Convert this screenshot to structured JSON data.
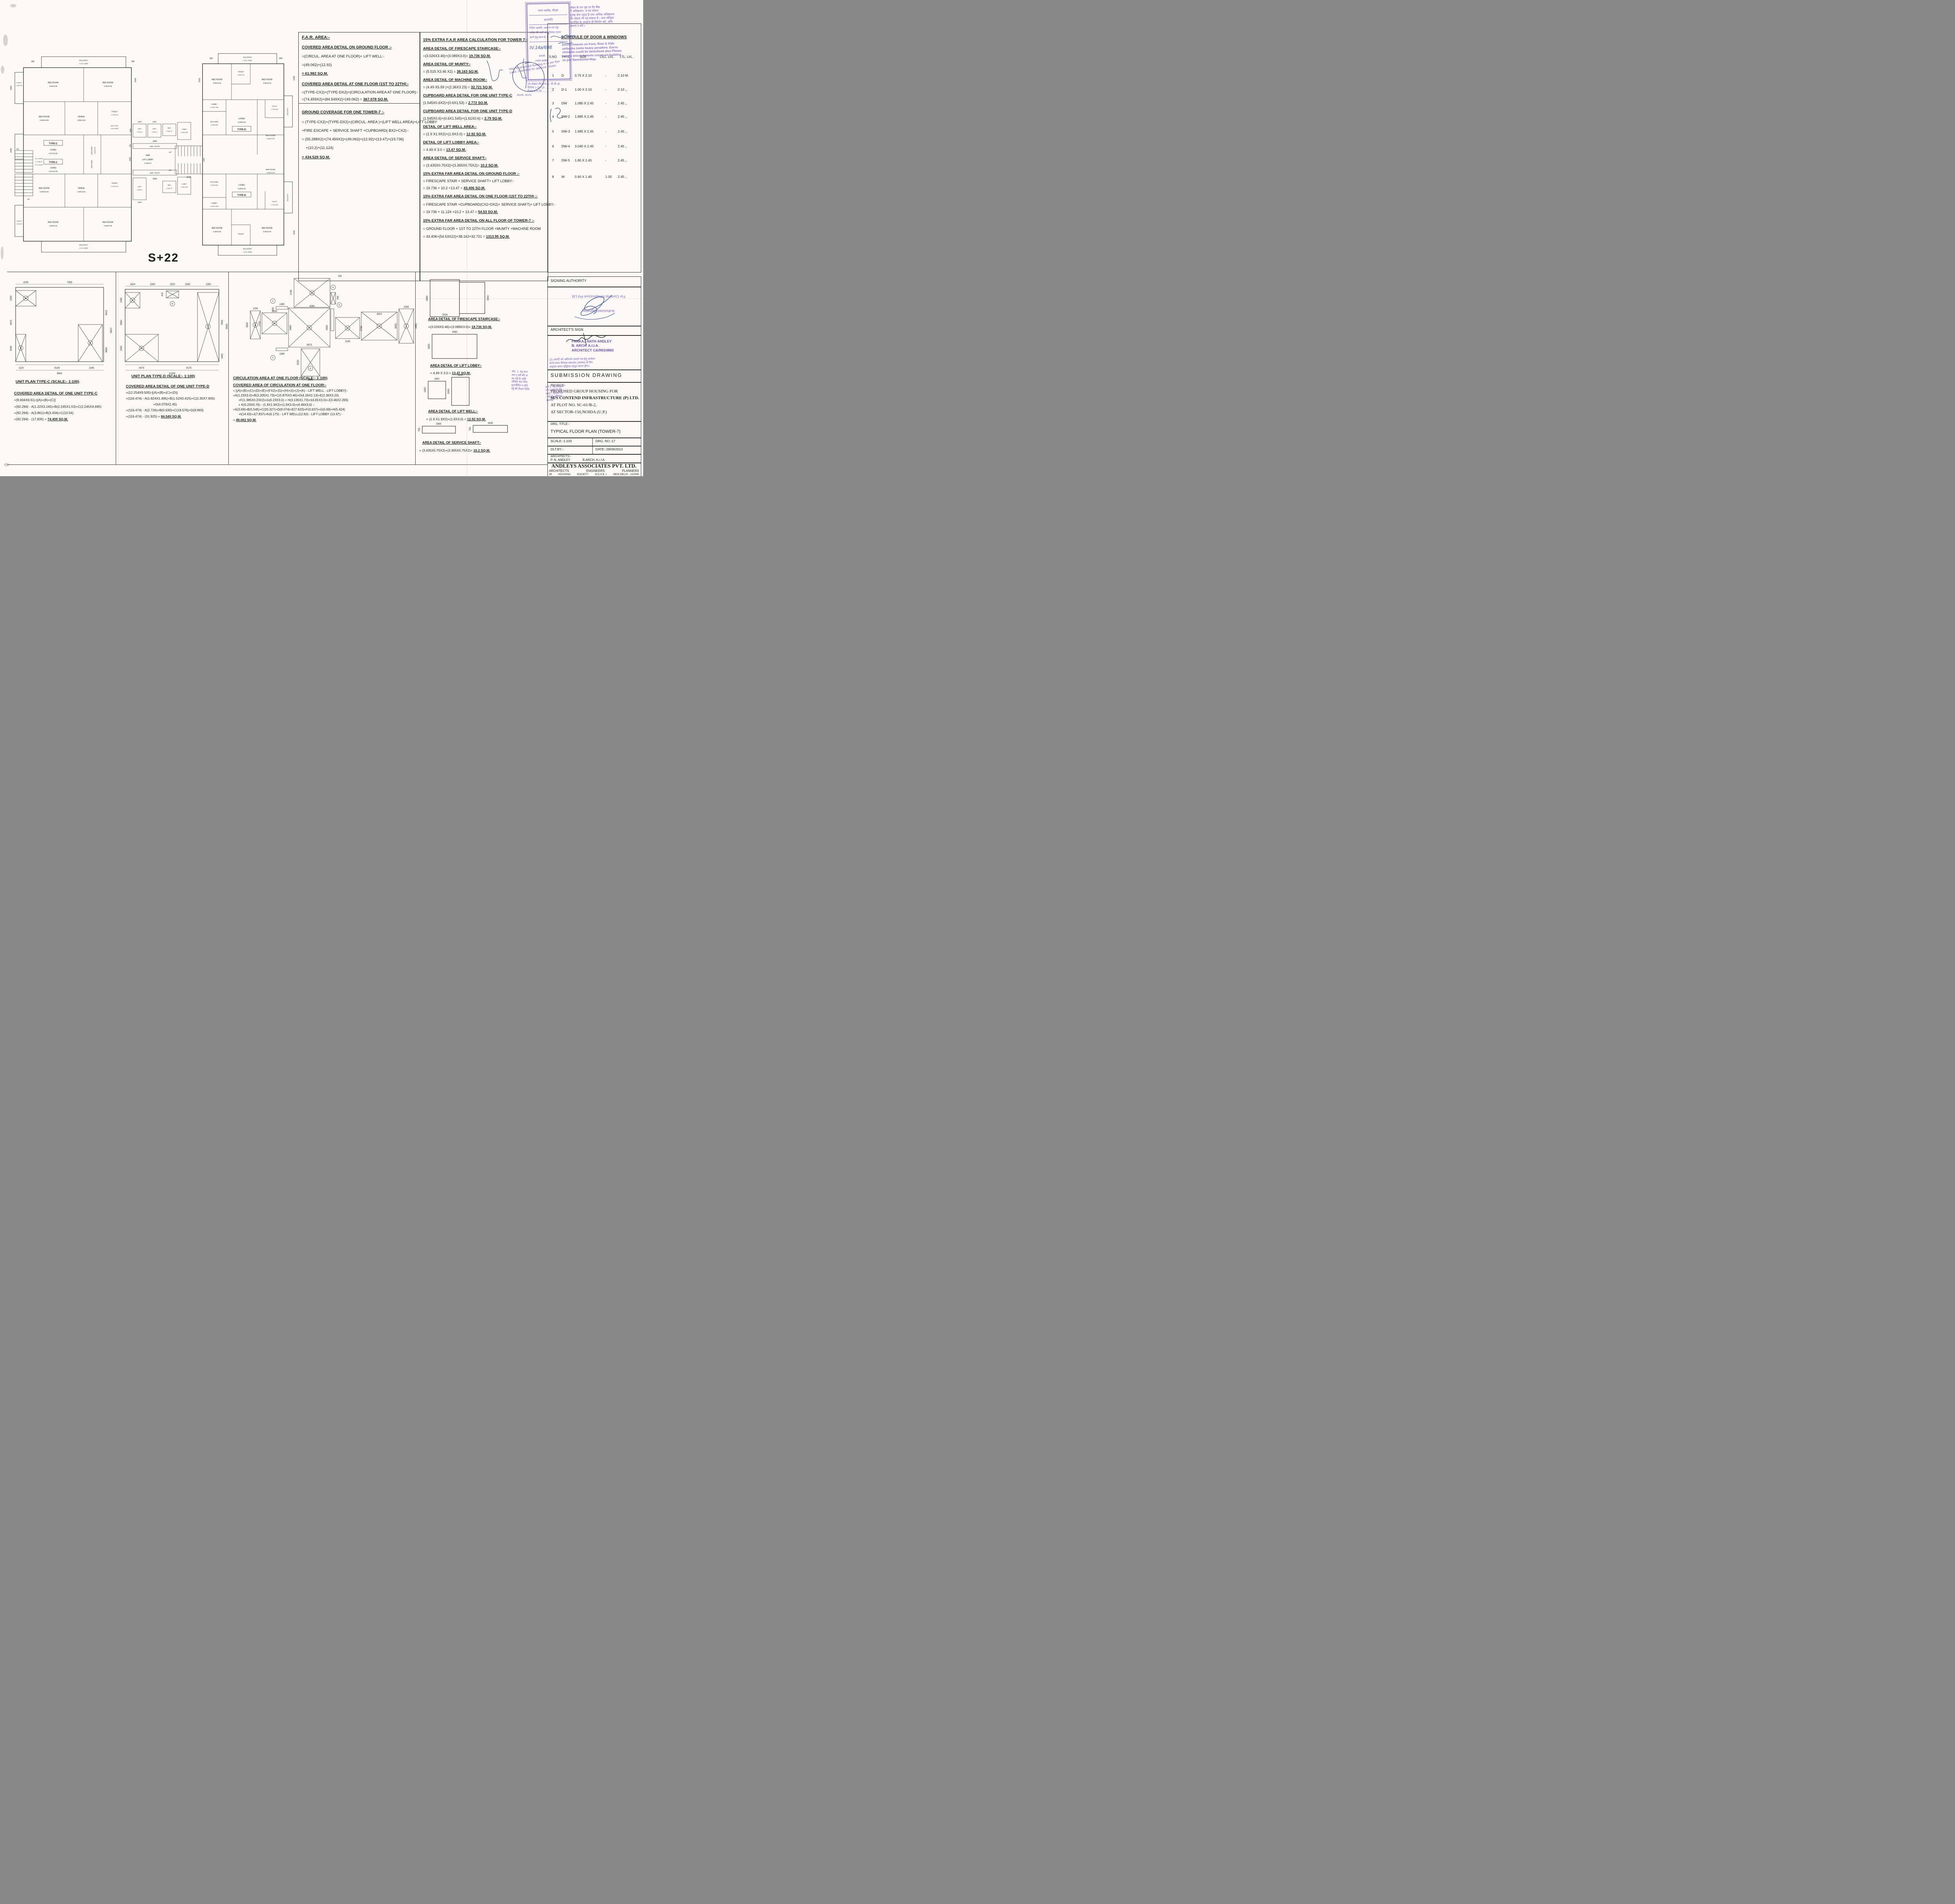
{
  "plan": {
    "storeys": "S+22",
    "type_c": "TYPE-C",
    "type_d": "TYPE-D",
    "balcony": "BALCONY",
    "balcony_w": "1.5 M. WIDE",
    "bed": "BED ROOM",
    "bed_366": "3.66X3.05",
    "bed_335": "3.35X3.05",
    "bed_3964": "3.964X3.05",
    "bed_d": "3.05X3.66",
    "toilet": "TOILET",
    "toilet_c": "2.13x1.52",
    "toilet_d1": "1.52x2.13",
    "toilet_d2": "1.71x2.165",
    "dining": "DINING",
    "dining_s": "3.05X3.05",
    "living": "LIVING",
    "living_c": "3.974X3.05",
    "living_d": "3.35X5.50",
    "kitchen": "KITCHEN",
    "kitchen_c": "1.82X3.05",
    "kitchen_d": "2.13X3.05",
    "lift": "LIFT",
    "lift_19": "1.9X1.9",
    "lift_193": "1.9X3.0",
    "lift_lobby": "LIFT LOBBY",
    "lift_lobby_s": "4.49X3.0",
    "ser_shaft": "SER. SHAFT",
    "wc": "W.C",
    "wc_s": "2.12x1.37",
    "lobby": "LOBBY",
    "lobby_s": "2.13X2.335",
    "up": "UP",
    "dn": "DN",
    "stair_w": "W.=1.50 M.",
    "stair_t": "T.=0.30 M.",
    "stair_r": "R.=0.15 M.",
    "d600": "600",
    "d1530": "1530",
    "d1545": "1545",
    "d1610": "1610",
    "d1495": "1495",
    "d4490": "4490",
    "d3365": "3365",
    "d1900": "1900",
    "d3000": "3000",
    "d4730": "4730",
    "d3435": "3435",
    "d750": "750",
    "d1500": "1500"
  },
  "far_area": {
    "title": "F.A.R. AREA:-",
    "s1_h": "COVERED AREA DETAIL ON GROUND FLOOR :-",
    "s1_l1": "=(CIRCUL. AREA AT ONE FLOOR)+ LIFT WELL:-",
    "s1_l2": "=(49.062)+(12.92)",
    "s1_r": "= 61.982 SQ.M.",
    "s2_h": "COVERED AREA DETAIL AT ONE FLOOR (1ST TO 22TH):-",
    "s2_l1": "=(TYPE-CX2)+(TYPE-DX2)+(CIRCULATION AREA AT ONE FLOOR):-",
    "s2_l2a": "=(74.459X2)+(84.549X2)+(49.062) = ",
    "s2_l2b": "367.078 SQ.M.",
    "gc_h": "GROUND COVERAGE FOR ONE TOWER-7 :-",
    "gc_l1": "= (TYPE-CX2)+(TYPE-DX2)+(CIRCUL. AREA )+(LIFT WELL AREA)+LIFT LOBBY",
    "gc_l2": "+FIRE ESCAPE + SERVICE SHAFT +CUPBOARD( BX2+CX2):-",
    "gc_l3": "= (55.288X2)+(74.459X2)+(49.062)+(12.92)+(13.47)+(19.736)",
    "gc_l4": "+(10.2)+(11.124)",
    "gc_r": "= 434.528 SQ.M."
  },
  "extra_far": {
    "title": "15% EXTRA F.A.R AREA CALCULATION FOR TOWER 7:-",
    "items": [
      {
        "h": "AREA DETAIL OF FIRESCAPE STAIRCASE:-",
        "f": "=(3.026X3.46)+(3.089X3.0)= ",
        "r": "19.736 SQ.M."
      },
      {
        "h": "AREA DETAIL OF MUMTY:-",
        "f": "= (5.515 X3.46 X2)  = ",
        "r": "38.163 SQ.M."
      },
      {
        "h": "AREA DETAIL OF MACHINE ROOM:-",
        "f": "= (4.49 X5.59 )+(2.36X3.23)  = ",
        "r": "32.721 SQ.M."
      },
      {
        "h": "CUPBOARD AREA DETAIL FOR ONE UNIT TYPE-C",
        "f": "(1.545X0.6X2)+(0.6X1.53) = ",
        "r": "2.772 SQ.M."
      },
      {
        "h": "CUPBOARD AREA DETAIL FOR ONE UNIT TYPE-D",
        "f": "(1.545X0.6)+(0.6X1.545)+(1.61X0.6) = ",
        "r": "2.79 SQ.M."
      },
      {
        "h": "DETAIL OF LIFT WELL AREA:-",
        "f": "= (1.9 X1.9X2)+(1.9X3.0)  = ",
        "r": "12.92 SQ.M."
      },
      {
        "h": "DETAIL OF LIFT LOBBY AREA:-",
        "f": "= 4.49 X 3.0  = ",
        "r": "13.47 SQ.M."
      },
      {
        "h": "AREA DETAIL OF SERVICE SHAFT:-",
        "f": "= (3.435X0.75X2)+(3.365X0.75X2)= ",
        "r": "10.2 SQ.M."
      },
      {
        "h": "15% EXTRA FAR AREA DETAIL  ON GROUND FLOOR :-",
        "l1": "= FIRESCAPE STAIR + SERVICE SHAFT+ LIFT LOBBY:-",
        "f": "= 19.736 + 10.2 +13.47  = ",
        "r": "43.406 SQ.M."
      },
      {
        "h": "15% EXTRA FAR AREA DETAIL ON ONE FLOOR (1ST TO 22TH) :-",
        "l1": "= FIRESCAPE STAIR +CUPBOARD(CX2+DX2)+ SERVICE SHAFT)+ LIFT LOBBY:-",
        "f": "= 19.736 + 11.124 +10.2 + 13.47 = ",
        "r": "54.53 SQ.M."
      },
      {
        "h": "15% EXTRA FAR AREA DETAIL ON ALL FLOOR OF TOWER-7 :-",
        "l1": "= GROUND FLOOR + 1ST  TO 22TH FLOOR +MUMTY  +MACHINE ROOM",
        "f": "= 43.406+(54.53X22)+38.163+32.721 = ",
        "r": "1313.95 SQ.M."
      }
    ]
  },
  "schedule": {
    "title": "SCHEDULE OF DOOR & WINDOWS",
    "headers": [
      "S.NO.",
      "TYPE",
      "SIZE",
      "CILL. LVL.",
      "LTL. LVL."
    ],
    "rows": [
      [
        "1",
        "D",
        "0.75  X 2.10",
        "-",
        "2.10 M."
      ],
      [
        "2",
        "D-1",
        "1.00   X 2.10",
        "-",
        "2.10 ,,"
      ],
      [
        "3",
        "DW",
        "1.080 X 2.45",
        "-",
        "2.45 ,,"
      ],
      [
        "4",
        "DW-2",
        "1.885 X 2.45",
        "-",
        "2.45 ,,"
      ],
      [
        "5",
        "DW-3",
        "1.685 X 2.45",
        "-",
        "2.45 ,,"
      ],
      [
        "6",
        "DW-4",
        "3.040 X 2.45",
        "-",
        "2.45 ,,"
      ],
      [
        "7",
        "DW-5",
        "1.80   X 2.45",
        "-",
        "2.45 ,,"
      ],
      [
        "8",
        "W",
        "0.60  X 1.40",
        "1.05",
        "2.45 ,,"
      ]
    ]
  },
  "unit_c": {
    "title": "UNIT PLAN TYPE-C  (SCALE:- 1:100)",
    "heading": "COVERED AREA DETAIL OF ONE UNIT TYPE-C",
    "l1": "=(9.604X9.61)-[(A)+(B)+(C)]",
    "l2": "=(92.294) - A(1.22X3.165)+B(2.245X1.53)+C(2.245X4.695)",
    "l3": "=(92.294) - A(3.861)+B(3.434)+C(10.54)",
    "l4a": "=(92.294) - (17.835) = ",
    "l4b": "74.459 SQ.M.",
    "marks": [
      "A",
      "B",
      "C"
    ],
    "dims": {
      "t1": "2245",
      "t2": "7359",
      "lf1": "1530",
      "lf2": "4915",
      "lf3": "3165",
      "b1": "1220",
      "b2": "6139",
      "b3": "2245",
      "b4": "9604",
      "r1": "4915",
      "r2": "9610",
      "r3": "4695"
    }
  },
  "unit_d": {
    "title": "UNIT PLAN TYPE-D  (SCALE:- 1:100)",
    "heading": "COVERED AREA DETAIL OF ONE UNIT TYPE-D",
    "l1": "=(12.254X9.505)-[(A)+(B)+(C)+(D)]",
    "l2": "=(116.474) - A(1.824X1.495)+B(1.52X0.415)+C(2.35X7.905)",
    "l3": "+D(4.079X2.45)",
    "l4": "=(116.474) - A(2.726)+B(0.630)+C(18.576)+D(9.993)",
    "l5a": "=(116.474) - (31.925) = ",
    "l5b": "84.549 SQ.M.",
    "marks": [
      "A",
      "B",
      "C",
      "D"
    ],
    "dims": {
      "t1": "1824",
      "t2": "3280",
      "t3": "1520",
      "t4": "3280",
      "t5": "2350",
      "bh": "415",
      "lf1": "1495",
      "lf2": "5560",
      "lf3": "2450",
      "b1": "4079",
      "b2": "8175",
      "b3": "12254",
      "r1": "7905",
      "r2": "9505",
      "r3": "1600"
    }
  },
  "circulation": {
    "title": "CIRCULATION AREA AT ONE FLOOR  (SCALE:- 1:100)",
    "heading": "COVERED AREA OF CIRCULATION AT ONE FLOOR:-",
    "l1": "= [(A)+(B)+(C)+(D)+(E)+(FX2)+(G)+(H)+(I)+(J)+(K) - LIFT WELL - LIFT LOBBY]:-",
    "l2": "=A(1.23X3.0)+B(3.205X1.73)+C(5.875X3.46)+D(4.26X2.13)+E(2.36X3.23)",
    "l3": "+F(1.385X0.23X2)+G(0.23X3.0) + H(3.135X1.73)+I(4.81X3.0)+J(3.46X2.265)",
    "l4": "+ K(0.23X0.76) - (1.9X1.9X2)+(1.9X3.0)+(4.49X3.0) :-",
    "l5": "=A(3.69)+B(5.545)+C(20.327)+D(9.074)+E(7.623)+F(0.637)+G(0.69)+H(5.424)",
    "l6": "+I(14.43)+J(7.837)+K(0.175) - LIFT WELL(12.92) - LIFT LOBBY (13.47):-",
    "ra": "= ",
    "rb": "49.062  SQ.M.",
    "marks": [
      "A",
      "B",
      "C",
      "D",
      "E",
      "F",
      "G",
      "H",
      "I",
      "J",
      "K"
    ],
    "dims": {
      "d2130": "2130",
      "d4260": "4260",
      "d230": "230",
      "d760": "760",
      "d1385": "1385",
      "d1230": "1230",
      "d3000": "3000",
      "d3205": "3205",
      "d1730": "1730",
      "d3460": "3460",
      "d5875": "5875",
      "d3135": "3135",
      "d4810": "4810",
      "d2265": "2265",
      "d3230": "3230",
      "d2360": "2360"
    }
  },
  "area_details": {
    "firescape": {
      "h": "AREA DETAIL OF FIRESCAPE STAIRCASE:-",
      "f": "=(3.026X3.46)+(3.089X3.0)= ",
      "r": "19.736 SQ.M.",
      "d1": "3460",
      "d2": "3026",
      "d3": "3000"
    },
    "lift_lobby": {
      "h": "AREA DETAIL OF LIFT LOBBY:-",
      "f": "= 4.49 X 3.0   = ",
      "r": "13.47 SQ.M.",
      "d1": "4490",
      "d2": "3000"
    },
    "lift_well": {
      "h": "AREA DETAIL OF LIFT WELL:-",
      "f": "= (1.9 X1.9X2)+(1.9X3.0)  = ",
      "r": "12.92 SQ.M.",
      "d1": "1900",
      "d2": "1900",
      "d3": "1900",
      "d4": "3000"
    },
    "service_shaft": {
      "h": "AREA DETAIL OF SERVICE SHAFT:-",
      "f": "= (3.435X0.75X2)+(3.365X0.75X2)= ",
      "r": "10.2 SQ.M.",
      "d1": "3365",
      "d2": "750",
      "d3": "3435",
      "d4": "750"
    }
  },
  "title_block": {
    "signing_authority": "SIGNING AUTHORITY",
    "architects_sign": "ARCHITECT'S SIGN",
    "submission": "SUBMISSION  DRAWING",
    "project_label": "PROJECT:-",
    "project_l1": "PROPOSED GROUP HOUSING FOR",
    "project_l2": "M/S CONTEND INFRASTRUCTURE (P) LTD.",
    "project_l3": "AT PLOT NO. SC-01/B-2,",
    "project_l4": "AT SECTOR-150,NOIDA (U.P.)",
    "drg_title_label": "DRG. TITLE:-",
    "drg_title": "TYPICAL FLOOR PLAN (TOWER-7)",
    "scale": "SCALE:-1:100",
    "drg_no": "DRG. NO.:17",
    "dlt_by": "DLT.BY.:-",
    "date": "DATE:-29/08/2013",
    "architects_label": "ARCHITECTS:-",
    "architect_name": "P. N. ANDLEY",
    "architect_qual": "B.ARCH.   A.I.I.A.",
    "firm": "ANDLEYS  ASSOCIATES  PVT.  LTD.",
    "firm_roles": [
      "ARCHITECTS",
      "ENGINEERS",
      "PLANNERS"
    ],
    "firm_addr": [
      "39",
      "HOUSING",
      "SOCIETY",
      "N.D.S.E.-I",
      "NEW DELHI - 110049"
    ]
  },
  "stamps": {
    "box_title": "भवन प्रकोष्ठ, नौएडा",
    "box_sub": "अनापत्ति",
    "box_l1": "निदेश-आबंटी, आबंटन एवं पट्टा",
    "box_l2": "प्रलेख की शर्तों को पूर्णतया पालन",
    "box_l3": "करने हेतु बाध्य है ।",
    "box_hand": "IV.14a/698",
    "box_post1": "प्रभारी",
    "box_post2": "(भवन प्रकोष्ठ)",
    "box_f1": "पत्र संख्या नौएडा/भ.प्र. वी.वी.आ.",
    "box_f2": "दिनांक 1-11-13 .............",
    "box_f3": "वैधता 5.4.25 .............",
    "enc_h1": "अंकर के यग पृष्ठ पर मैट बैंक",
    "enc_h2": "में अतिक्रमण, जं घर योजन",
    "enc_h3": "शुल्क देना पड़ता है तथा अधिक अतिक्रमण",
    "enc_h4": "का तोड़ना भी पड़ सकता है । अतः स्वीकृत",
    "enc_h5": "मानचित्र के अनुसार ही निर्माण करें, अति-",
    "enc_h6": "क्रमण न करें ।",
    "enc_e1": "Encrochments on front, Rear & Side",
    "enc_e2": "setbacks invite heavy penalties. Encro",
    "enc_e3": "chments could be demolised also Please",
    "enc_e4": "avoide encrochments construct building",
    "enc_e5": "as per Sanctioned Map.",
    "map_l1": "Map for proposed Building is as per Bye",
    "map_l2": "Laws. Submitted for approval please.",
    "asstt": "Asstt. Arch.",
    "architect_stamp_l1": "PANKAJ NATH ANDLEY",
    "architect_stamp_l2": "B. ARCH.  A.I.I.A.",
    "architect_stamp_l3": "ARCHITECT CA/99/24860",
    "contend_l1": "For Contend Infrastructure Pvt Ltd.",
    "contend_l2": "Authorized Signatory",
    "note_l1": "नोट: 1. यह मान",
    "note_l2": "लय 5 वर्ष की अ",
    "note_l3": "का पट्टे के अधि",
    "note_l4": "जीवित करा लिए",
    "note_l5": "धुनर्जीवित न होने",
    "note_l6": "पट्टे की वैधता तिथि",
    "occ_l1": "(2) आवंटी को अधिभोग प्रमाण पत्र हेतु आवेदन",
    "occ_l2": "करते समय विकास प्रबन्धक (आवास) से निय",
    "occ_l3": "अनुसार समय वृद्धिपत्र प्रस्तुत करना होगा।",
    "side_l1": "शर्त 1. यह स्वीकृति",
    "side_l2": "पत्र 5 वर्ष हेतु वैध",
    "side_l3": "रहेगा । दिनांक की",
    "side_l4": "। पट्टे के अधिकार",
    "side_l5": "उपलब्ध"
  }
}
